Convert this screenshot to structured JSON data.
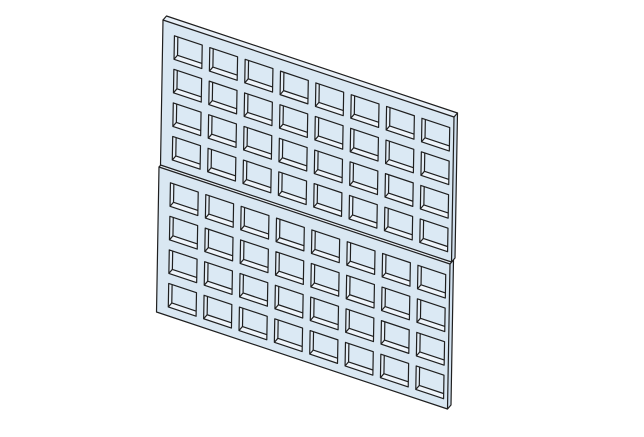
{
  "scene": {
    "description": "Isometric CAD view of two stacked perforated square-hole panels",
    "background_color": "#ffffff",
    "edge_color": "#1f1f1f",
    "edge_width": 1.2,
    "viewport": {
      "width": 644,
      "height": 437
    }
  },
  "model": {
    "instances": [
      {
        "id": "panel-top",
        "origin": [
          163,
          20
        ]
      },
      {
        "id": "panel-bottom",
        "origin": [
          159,
          167
        ]
      }
    ],
    "panel": {
      "columns": 8,
      "rows": 4,
      "holes_per_panel": 32,
      "hole_shape": "square",
      "face_color": "#d9e7f2",
      "floor_color": "#dbe9f4",
      "bottom_wall_color": "#eef4fa",
      "left_wall_color": "#e3edf6",
      "top_edge_color": "#e8f0f8",
      "right_edge_color": "#d2e1ef"
    },
    "projection": {
      "u_axis": [
        291,
        97
      ],
      "v_axis": [
        -2.5,
        145
      ],
      "thickness_offset": [
        3.5,
        -4
      ],
      "hole_grid": {
        "margin_u": 0.04,
        "pitch_u": 0.1215,
        "hole_u": 0.0955,
        "margin_v": 0.082,
        "pitch_v": 0.2315,
        "hole_v": 0.162
      }
    }
  }
}
